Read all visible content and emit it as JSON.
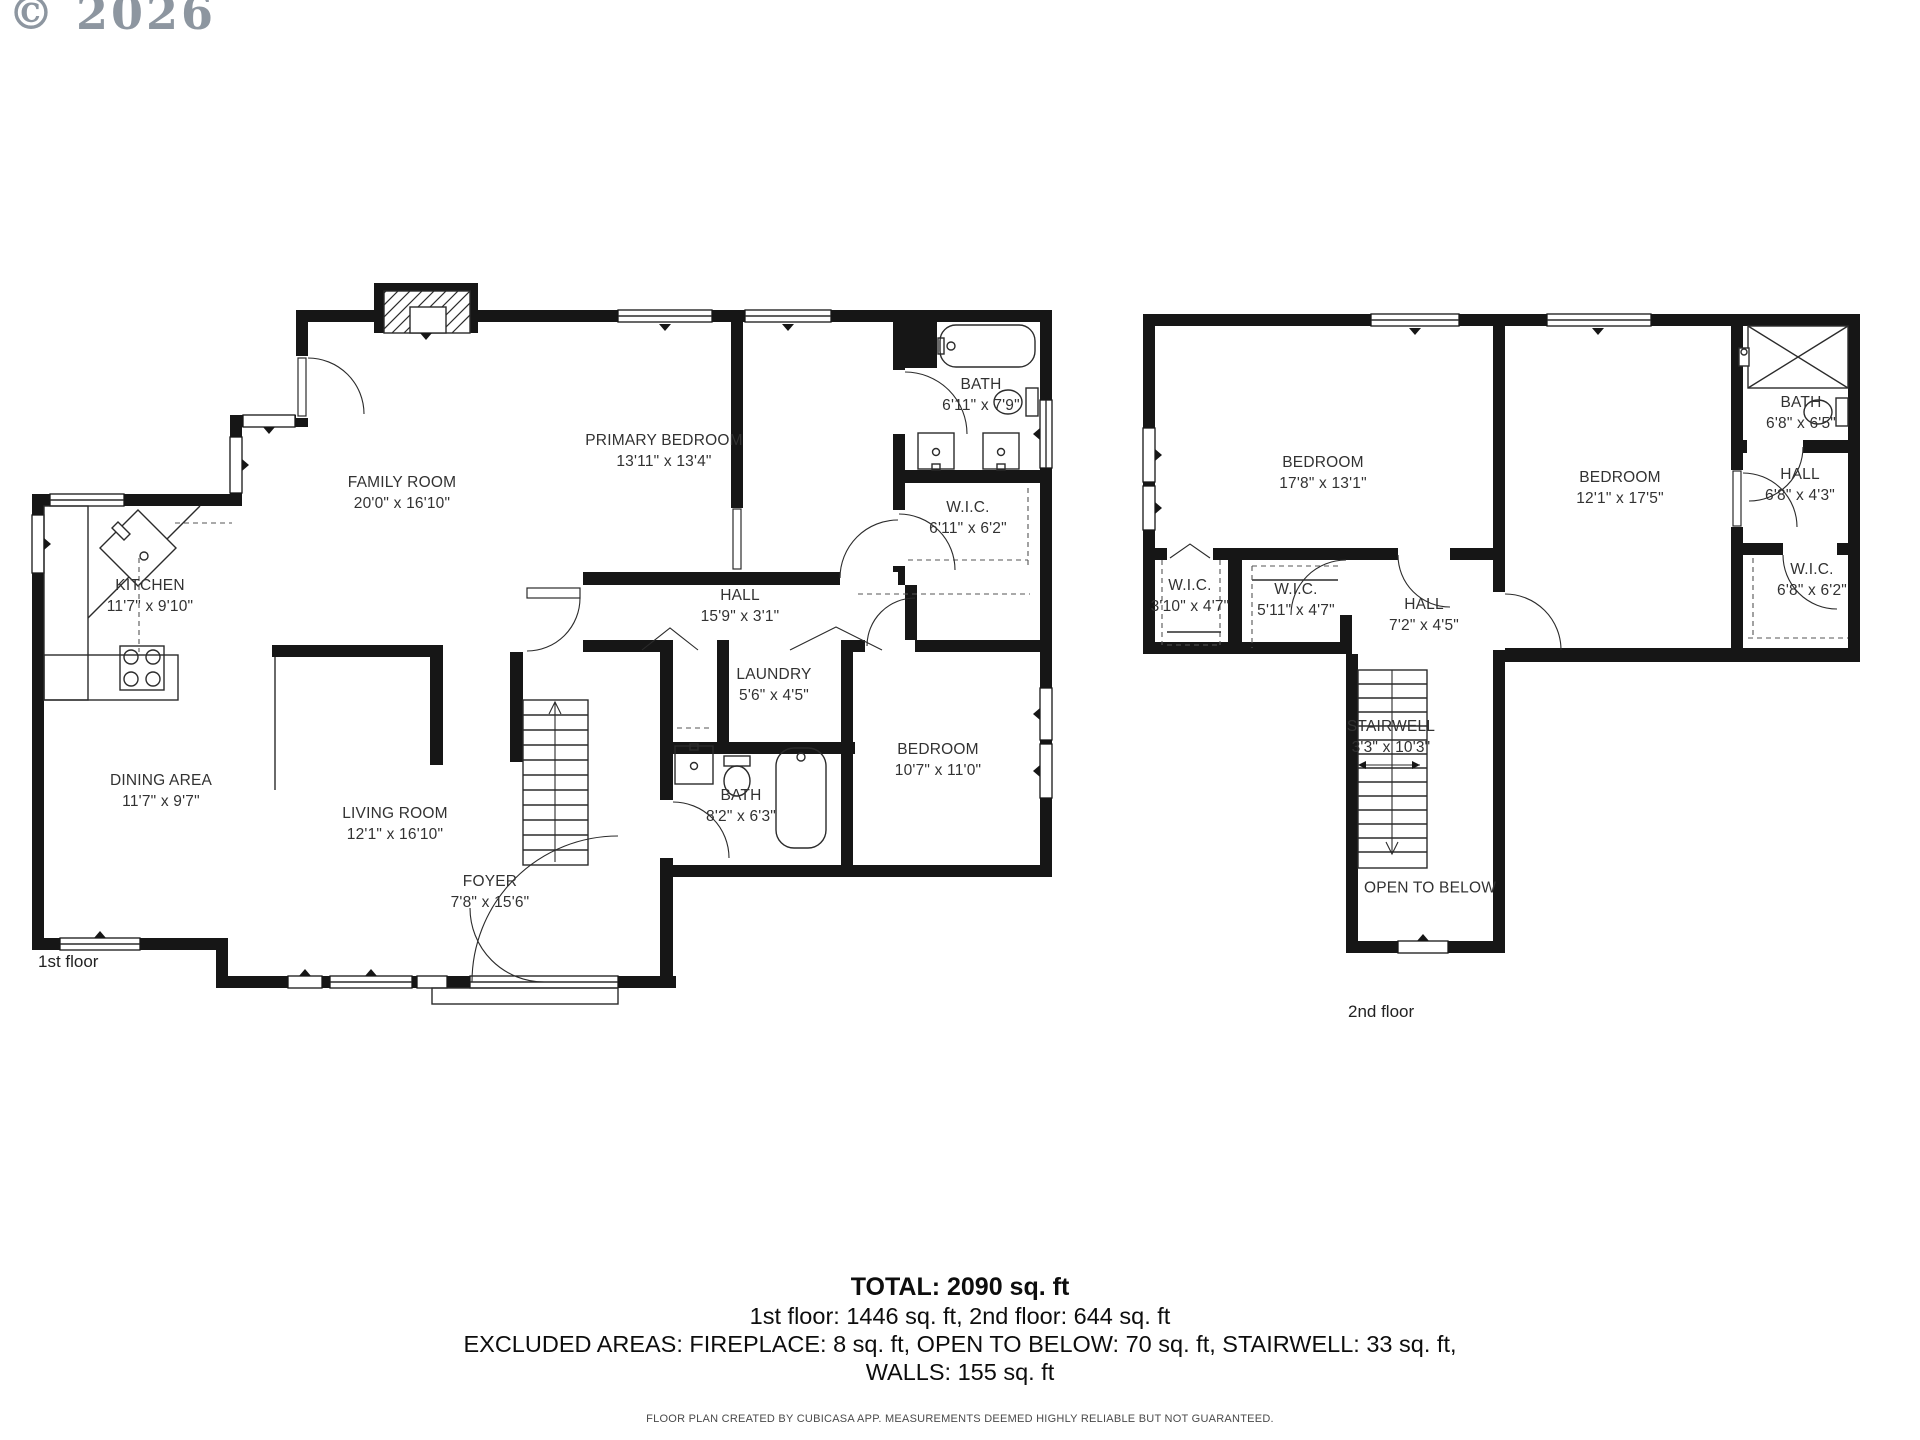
{
  "copyright": "© 2026",
  "floor1": {
    "floor_label": "1st floor",
    "rooms": [
      {
        "name": "FAMILY ROOM",
        "dims": "20'0\" x 16'10\"",
        "x": 402,
        "y": 494
      },
      {
        "name": "PRIMARY BEDROOM",
        "dims": "13'11\" x 13'4\"",
        "x": 664,
        "y": 452
      },
      {
        "name": "BATH",
        "dims": "6'11\" x 7'9\"",
        "x": 981,
        "y": 396
      },
      {
        "name": "W.I.C.",
        "dims": "6'11\" x 6'2\"",
        "x": 968,
        "y": 519
      },
      {
        "name": "KITCHEN",
        "dims": "11'7\" x 9'10\"",
        "x": 150,
        "y": 597
      },
      {
        "name": "HALL",
        "dims": "15'9\" x 3'1\"",
        "x": 740,
        "y": 607
      },
      {
        "name": "LAUNDRY",
        "dims": "5'6\" x 4'5\"",
        "x": 774,
        "y": 686
      },
      {
        "name": "DINING AREA",
        "dims": "11'7\" x 9'7\"",
        "x": 161,
        "y": 792
      },
      {
        "name": "LIVING ROOM",
        "dims": "12'1\" x 16'10\"",
        "x": 395,
        "y": 825
      },
      {
        "name": "BATH",
        "dims": "8'2\" x 6'3\"",
        "x": 741,
        "y": 807
      },
      {
        "name": "BEDROOM",
        "dims": "10'7\" x 11'0\"",
        "x": 938,
        "y": 761
      },
      {
        "name": "FOYER",
        "dims": "7'8\" x 15'6\"",
        "x": 490,
        "y": 893
      }
    ]
  },
  "floor2": {
    "floor_label": "2nd floor",
    "rooms": [
      {
        "name": "BEDROOM",
        "dims": "17'8\" x 13'1\"",
        "x": 1323,
        "y": 474
      },
      {
        "name": "BEDROOM",
        "dims": "12'1\" x 17'5\"",
        "x": 1620,
        "y": 489
      },
      {
        "name": "BATH",
        "dims": "6'8\" x 6'5\"",
        "x": 1801,
        "y": 414
      },
      {
        "name": "HALL",
        "dims": "6'8\" x 4'3\"",
        "x": 1800,
        "y": 486
      },
      {
        "name": "W.I.C.",
        "dims": "3'10\" x 4'7\"",
        "x": 1190,
        "y": 597
      },
      {
        "name": "W.I.C.",
        "dims": "5'11\" x 4'7\"",
        "x": 1296,
        "y": 601
      },
      {
        "name": "HALL",
        "dims": "7'2\" x 4'5\"",
        "x": 1424,
        "y": 616
      },
      {
        "name": "W.I.C.",
        "dims": "6'8\" x 6'2\"",
        "x": 1812,
        "y": 581
      },
      {
        "name": "STAIRWELL",
        "dims": "3'3\" x 10'3\"",
        "x": 1391,
        "y": 738
      },
      {
        "name": "OPEN TO BELOW",
        "dims": "",
        "x": 1430,
        "y": 889
      }
    ]
  },
  "summary": {
    "total": "TOTAL: 2090 sq. ft",
    "floors": "1st floor: 1446 sq. ft, 2nd floor: 644 sq. ft",
    "excluded": "EXCLUDED AREAS: FIREPLACE: 8 sq. ft, OPEN TO BELOW: 70 sq. ft, STAIRWELL: 33 sq. ft,",
    "walls": "WALLS: 155 sq. ft"
  },
  "footer": "FLOOR PLAN CREATED BY CUBICASA APP. MEASUREMENTS DEEMED HIGHLY RELIABLE BUT NOT GUARANTEED."
}
